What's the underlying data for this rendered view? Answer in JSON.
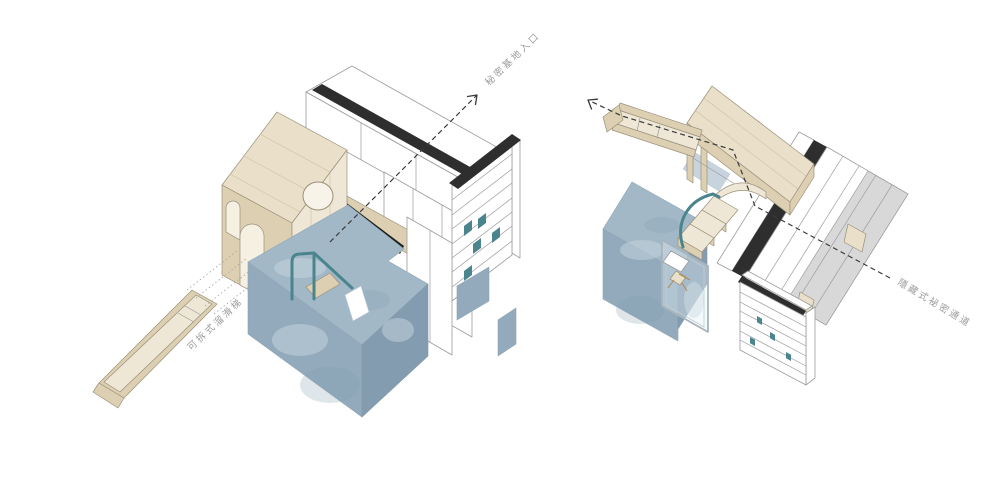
{
  "colors": {
    "background": "#ffffff",
    "outline_gray": "#9b9b9b",
    "wood_outline": "#9a8f7a",
    "wood_light": "#eae0ca",
    "wood_xlight": "#efe7d6",
    "wood_mid": "#ddd0b2",
    "panel_white": "#ffffff",
    "panel_gray": "#d8d8d8",
    "accent_black": "#2e2e2e",
    "floor_blue": "#a2b8c7",
    "floor_blue_mid": "#92aabc",
    "floor_blue_dark": "#839cb0",
    "teal": "#4a858e",
    "arrow_dark": "#3a3a3a",
    "label_gray": "#9c9c9c"
  },
  "left_view": {
    "annotations": [
      {
        "id": "secret-base-entrance",
        "text": "秘密基地入口"
      },
      {
        "id": "detachable-slide",
        "text": "可拆式溜滑梯"
      }
    ]
  },
  "right_view": {
    "annotations": [
      {
        "id": "hidden-secret-passage",
        "text": "隱藏式祕密通道"
      }
    ]
  }
}
